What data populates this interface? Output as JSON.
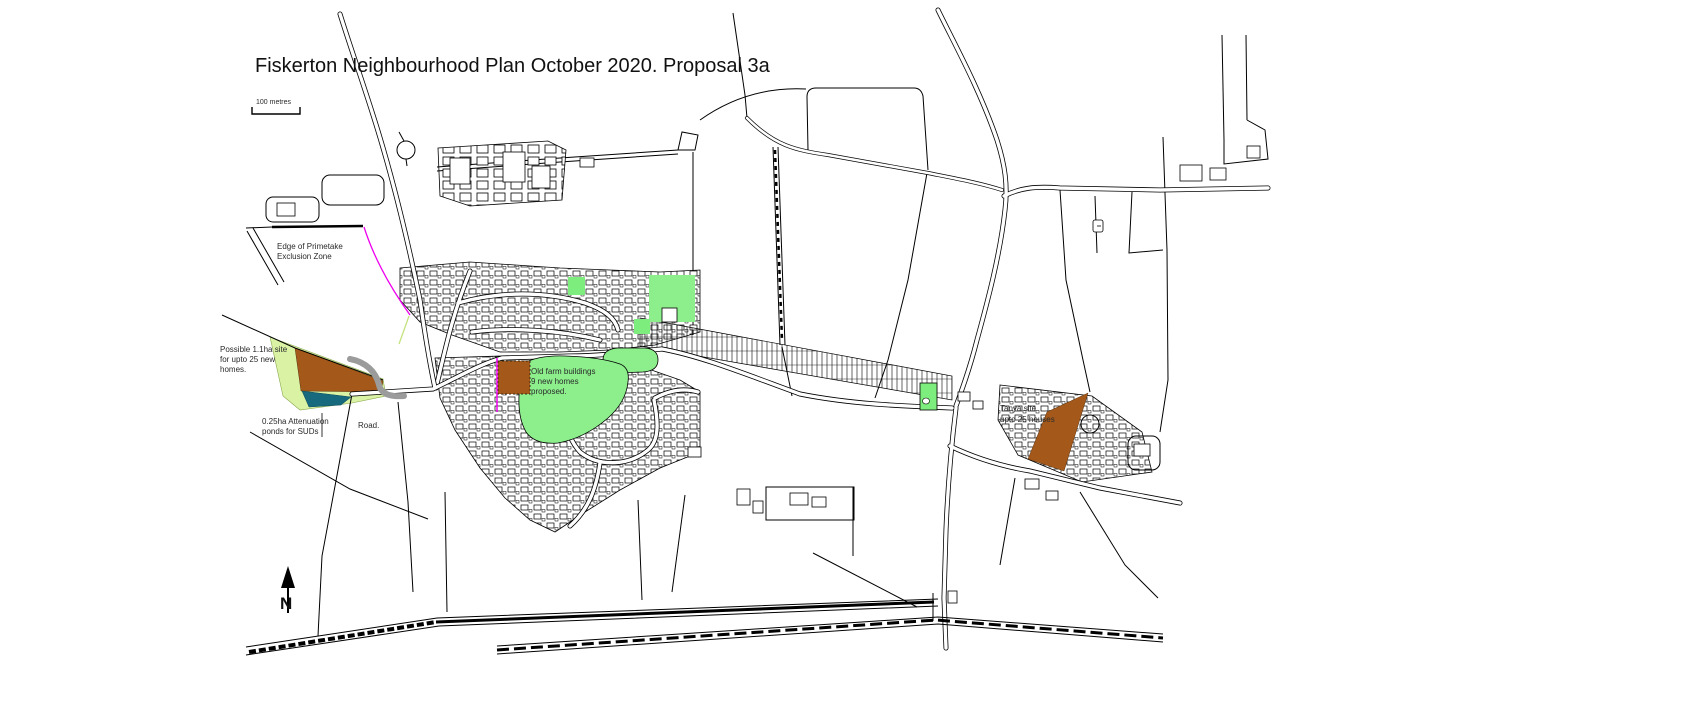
{
  "map": {
    "title": "Fiskerton Neighbourhood Plan October 2020. Proposal 3a",
    "scale_bar_label": "100  metres",
    "north_label": "N",
    "annotations": {
      "exclusion_zone": [
        "Edge of Primetake",
        "Exclusion Zone"
      ],
      "possible_site": [
        "Possible 1.1ha site",
        "for upto 25 new",
        "homes."
      ],
      "attenuation_ponds": [
        "0.25ha Attenuation",
        "ponds for SUDs"
      ],
      "road": [
        "Road."
      ],
      "old_farm": [
        "Old farm buildings",
        "9 new homes",
        "proposed."
      ],
      "tanya_site": [
        "Tanya site",
        "upto 25 houses"
      ]
    },
    "colors": {
      "proposal_site_brown": "#a4591b",
      "proposal_green": "#7dee7d",
      "open_space_green": "#8cef8c",
      "site_boundary_pale_green": "#d9f2a4",
      "attenuation_pond_teal": "#17697d",
      "exclusion_zone_magenta": "#ee00ee",
      "proposed_road_grey": "#9b9b9b"
    }
  }
}
